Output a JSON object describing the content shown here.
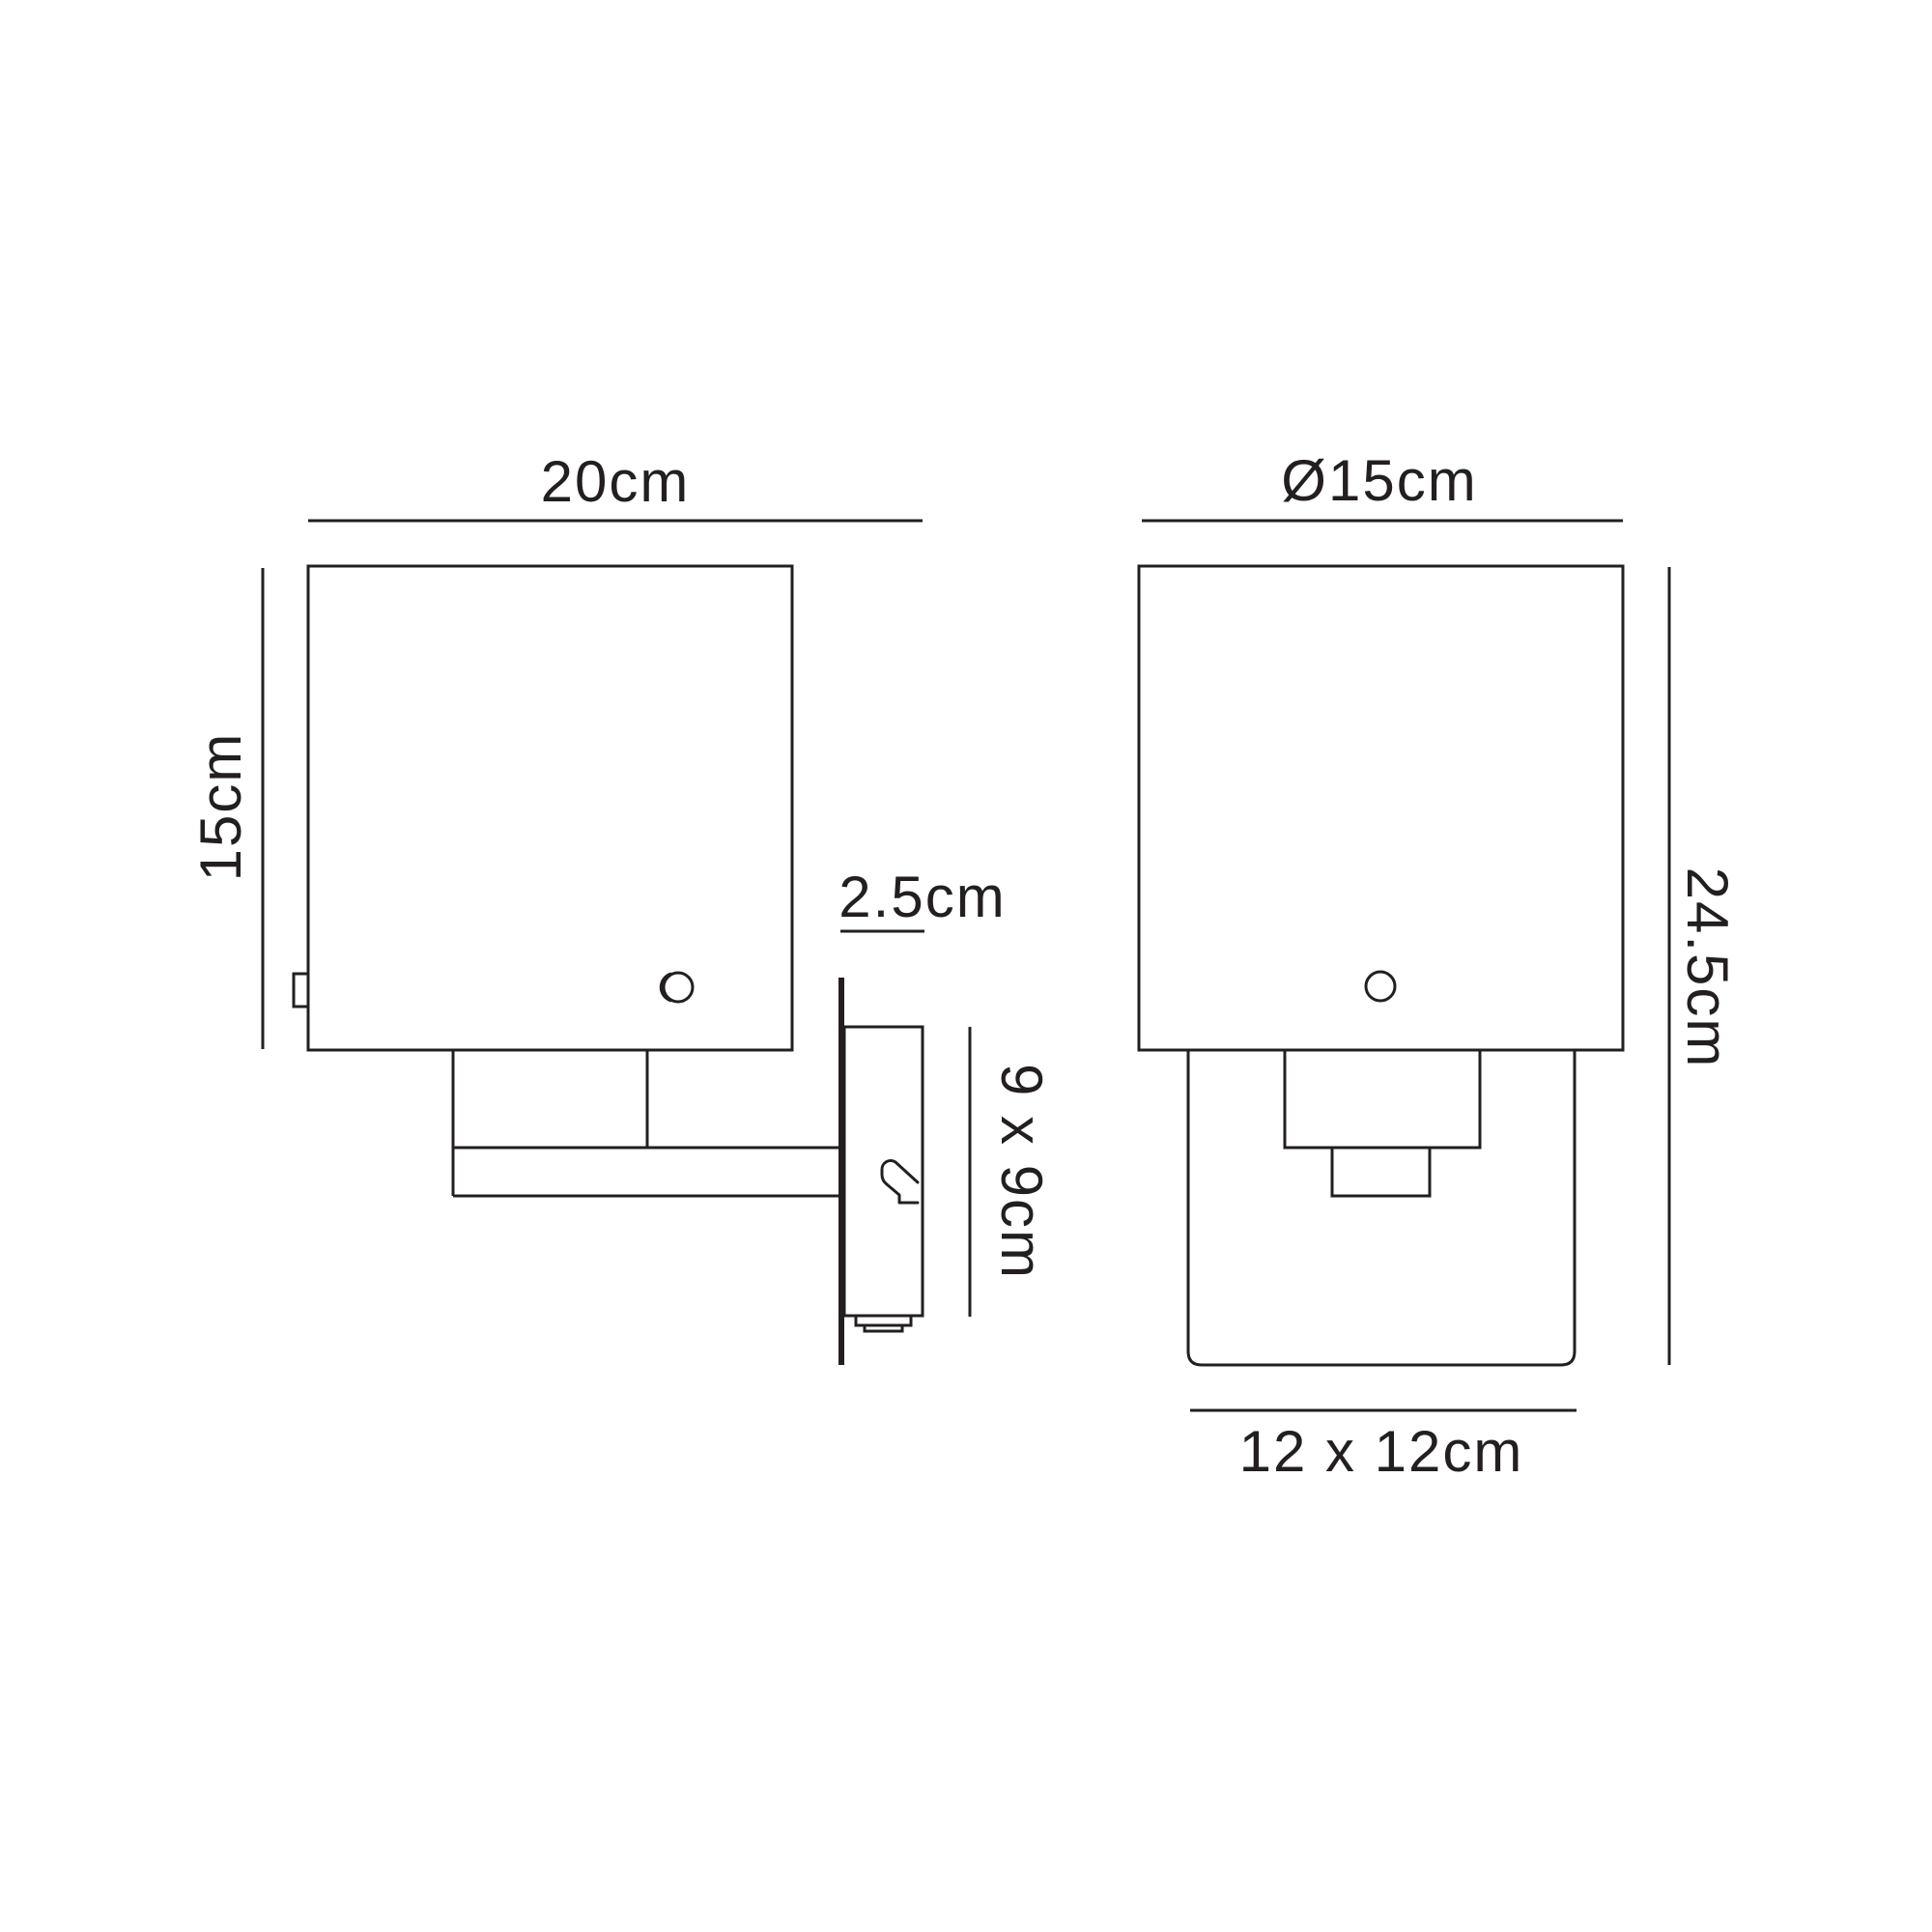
{
  "diagram": {
    "labels": {
      "side_width": "20cm",
      "side_height": "15cm",
      "plate_depth": "2.5cm",
      "plate_size": "9 x 9cm",
      "front_diameter": "Ø15cm",
      "front_height": "24.5cm",
      "front_glass": "12 x 12cm"
    },
    "colors": {
      "line": "#231f20",
      "text": "#231f20",
      "background": "#ffffff"
    }
  }
}
